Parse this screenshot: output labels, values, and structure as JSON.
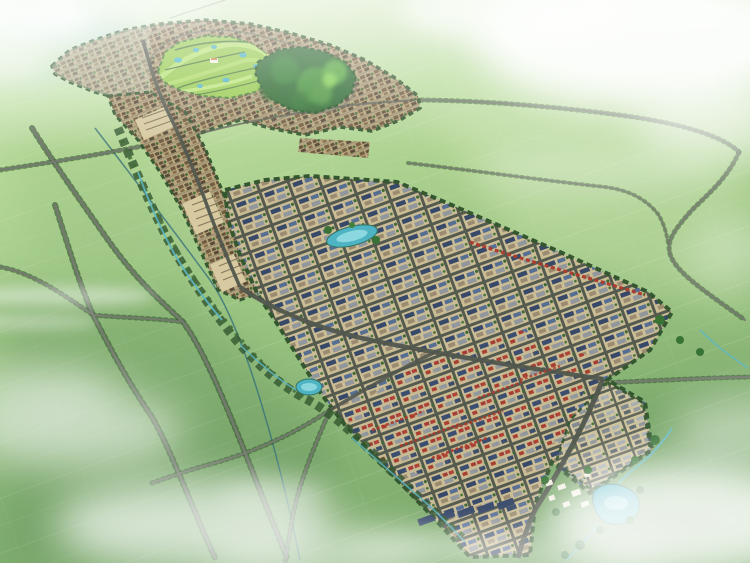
{
  "canvas": {
    "width": 750,
    "height": 563
  },
  "scene": {
    "type": "aerial-perspective-masterplan-rendering",
    "setting": "bird's-eye rendering of a planned town set in green farmland under haze and clouds",
    "regions": [
      {
        "id": "farmland",
        "label": "green farmland with faint parcel lines"
      },
      {
        "id": "golf-course",
        "label": "bright golf course with fairways and small ponds"
      },
      {
        "id": "forest-hill",
        "label": "dark forested hill"
      },
      {
        "id": "north-town",
        "label": "low-rise town ring around golf course and hill"
      },
      {
        "id": "central-corridor",
        "label": "main street corridor of tan blocks"
      },
      {
        "id": "industrial-grid",
        "label": "large gridded district with blue, gray and red roofs"
      },
      {
        "id": "greenway",
        "label": "tree-lined greenway with winding streams and ponds"
      },
      {
        "id": "resort-lake",
        "label": "turquoise lake with white resort buildings"
      },
      {
        "id": "roads",
        "label": "tree-lined rural roads crossing the fields"
      },
      {
        "id": "clouds",
        "label": "white clouds and atmospheric haze"
      },
      {
        "id": "wetland",
        "label": "pale blue wetland at the upper left"
      }
    ]
  },
  "palette": {
    "field_light": "#cfe7b4",
    "field_mid": "#a4cd87",
    "field_deep": "#7fae6a",
    "field_dark": "#5d8a55",
    "horizon": "#eef6e6",
    "cloud": "#ffffff",
    "water_pale": "#b9dde0",
    "canal": "#2f6b74",
    "stream": "#55b4c4",
    "pond": "#46b0c2",
    "pond_light": "#93dde6",
    "road": "#6f7468",
    "road_dark": "#4a4f46",
    "tree": "#2b4e26",
    "tree_mid": "#3a652f",
    "golf": "#93c847",
    "golf_light": "#b9e272",
    "forest": "#26632a",
    "forest_light": "#7ecf4e",
    "town_tan": "#b6a078",
    "plaza_tan": "#d6c89e",
    "grid_tan": "#c9b990",
    "grid_tan_light": "#d3c69e",
    "roof_blue": "#2e3f63",
    "roof_blue_light": "#50678f",
    "roof_red": "#aa2f22",
    "roof_gray": "#8d9298",
    "roof_white": "#f3efe2",
    "clubhouse_roof": "#c77f3e"
  }
}
